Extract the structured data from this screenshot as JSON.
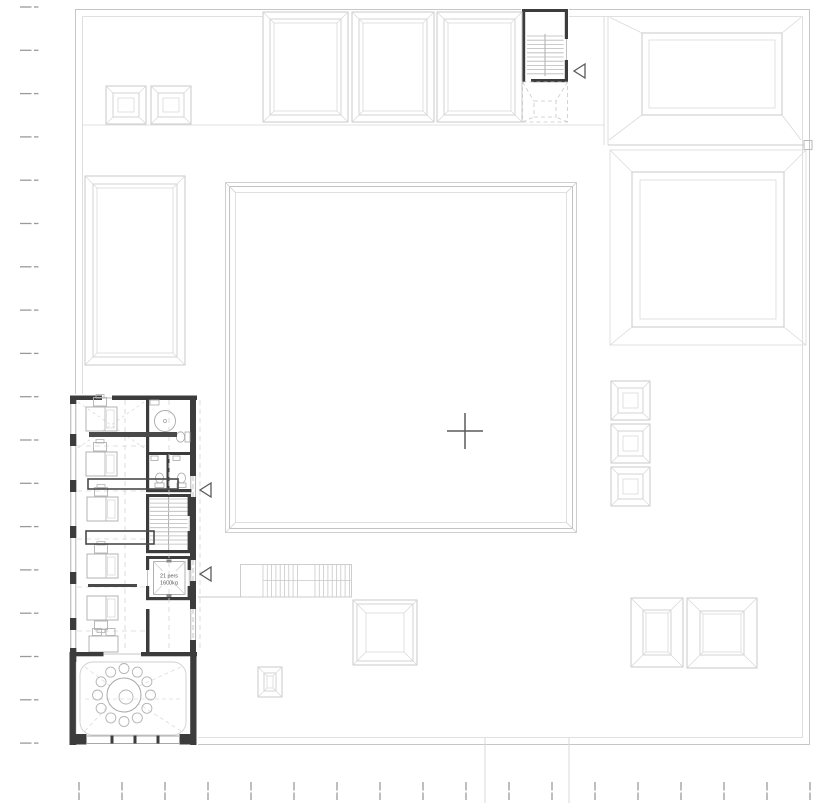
{
  "colors": {
    "roof_line": "#c9c9c9",
    "roof_line_light": "#d9d9d9",
    "wall_dark": "#3c3c3c",
    "furniture": "#b3b3b3",
    "fixture": "#a8a8a8",
    "dashed": "#d6d6d6",
    "boundary_dash": "#9a9a9a",
    "marker": "#5a5a5a",
    "tread": "#b8b8b8"
  },
  "elevator_label": {
    "line1": "21 pers",
    "line2": "1600kg"
  },
  "site_boundary": {
    "left_dashes": {
      "x": 20,
      "y_start": 7,
      "step": 43.3,
      "count": 18
    },
    "bottom_dashes": {
      "y": 782,
      "x_start": 79,
      "step": 43,
      "count": 18
    }
  },
  "skylights": {
    "pyramids": [
      [
        106,
        86,
        40,
        38
      ],
      [
        151,
        86,
        40,
        38
      ],
      [
        611,
        381,
        39,
        39
      ],
      [
        611,
        424,
        39,
        39
      ],
      [
        611,
        467,
        39,
        39
      ]
    ],
    "framed": [
      {
        "x": 263,
        "y": 12,
        "w": 85,
        "h": 110,
        "i1": 7,
        "i2": 11
      },
      {
        "x": 352,
        "y": 12,
        "w": 82,
        "h": 110,
        "i1": 7,
        "i2": 11
      },
      {
        "x": 437,
        "y": 12,
        "w": 85,
        "h": 110,
        "i1": 7,
        "i2": 11
      },
      {
        "x": 85,
        "y": 176,
        "w": 100,
        "h": 189,
        "i1": 8,
        "i2": 12
      },
      {
        "x": 353,
        "y": 600,
        "w": 64,
        "h": 65,
        "i1": 4,
        "i2": 13
      },
      {
        "x": 258,
        "y": 667,
        "w": 24,
        "h": 30,
        "i1": 6,
        "i2": 9
      },
      {
        "x": 631,
        "y": 598,
        "w": 52,
        "h": 69,
        "i1": 12,
        "i2": 15
      },
      {
        "x": 687,
        "y": 598,
        "w": 70,
        "h": 70,
        "i1": 13,
        "i2": 16
      }
    ]
  },
  "stairs": {
    "top": {
      "tread_x": [
        527,
        545,
        563.6
      ],
      "tread_y0": 36,
      "tread_y1": 74,
      "step": 4.2
    },
    "interior": {
      "tread_x": [
        150,
        168.5,
        187.5
      ],
      "tread_y0": 499,
      "tread_y1": 548,
      "step": 4.1
    },
    "exterior": {
      "y0": 564.5,
      "y1": 597,
      "flight1": [
        263,
        301
      ],
      "flight2": [
        315,
        351
      ],
      "step": 4.3
    }
  },
  "office": {
    "desks": [
      {
        "x": 86,
        "y": 407,
        "chair": "top"
      },
      {
        "x": 86,
        "y": 452,
        "chair": "top"
      },
      {
        "x": 87,
        "y": 497,
        "chair": "top"
      },
      {
        "x": 87,
        "y": 554,
        "chair": "top"
      },
      {
        "x": 87,
        "y": 596,
        "chair": "bottom"
      },
      {
        "x": 89,
        "y": 636,
        "chair": "top2",
        "horizontal": true
      }
    ],
    "cabinets": [
      {
        "type": "filled",
        "x": 89,
        "y": 432,
        "w": 88,
        "h": 5
      },
      {
        "type": "outline",
        "x": 88,
        "y": 479,
        "w": 90,
        "h": 10
      },
      {
        "type": "outline",
        "x": 86,
        "y": 531,
        "w": 68,
        "h": 13
      },
      {
        "type": "filled",
        "x": 88,
        "y": 584,
        "w": 49,
        "h": 3
      }
    ]
  },
  "meeting_room": {
    "table": {
      "cx": 124,
      "cy": 695,
      "r": 17,
      "inner_r": 7,
      "inner_dx": 2,
      "inner_dy": 2
    },
    "chairs": {
      "count": 12,
      "radius": 26.5,
      "r": 5
    }
  },
  "markers": {
    "cross": {
      "x": 465,
      "y": 431,
      "arm": 18
    },
    "triangles": [
      [
        574,
        64
      ],
      [
        200,
        483
      ],
      [
        200,
        567
      ]
    ]
  }
}
